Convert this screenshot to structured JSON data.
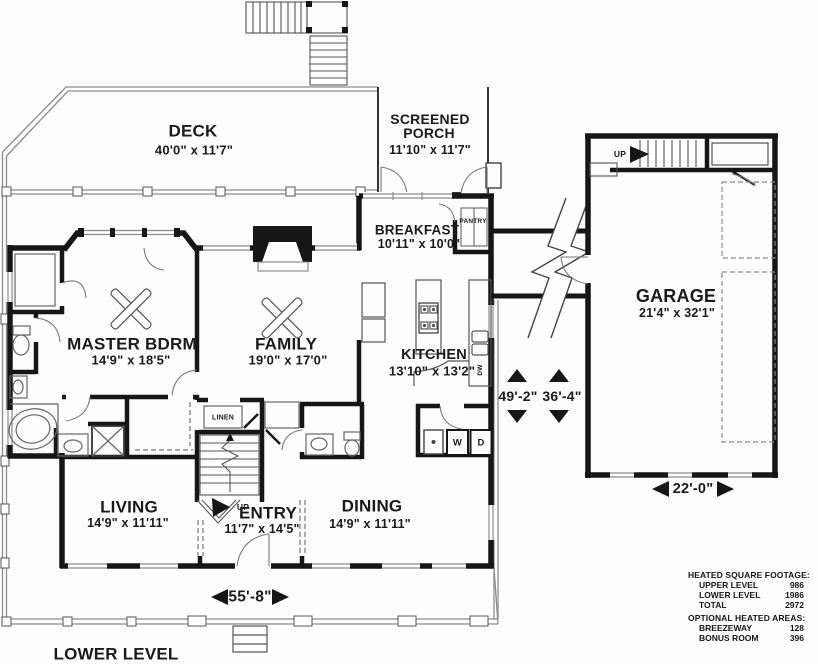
{
  "plan": {
    "level_title": "LOWER LEVEL",
    "rooms": {
      "deck": {
        "name": "DECK",
        "dims": "40'0\" x 11'7\""
      },
      "screened_porch": {
        "line1": "SCREENED",
        "line2": "PORCH",
        "dims": "11'10\" x 11'7\""
      },
      "breakfast": {
        "name": "BREAKFAST",
        "dims": "10'11\" x 10'0\""
      },
      "pantry": {
        "name": "PANTRY"
      },
      "master_bdrm": {
        "name": "MASTER BDRM",
        "dims": "14'9\" x 18'5\""
      },
      "family": {
        "name": "FAMILY",
        "dims": "19'0\" x 17'0\""
      },
      "kitchen": {
        "name": "KITCHEN",
        "dims": "13'10\" x 13'2\""
      },
      "garage": {
        "name": "GARAGE",
        "dims": "21'4\" x 32'1\""
      },
      "living": {
        "name": "LIVING",
        "dims": "14'9\" x 11'11\""
      },
      "entry": {
        "name": "ENTRY",
        "dims": "11'7\" x 14'5\""
      },
      "dining": {
        "name": "DINING",
        "dims": "14'9\" x 11'11\""
      },
      "linen": {
        "name": "LINEN"
      }
    },
    "markers": {
      "up_stairs_entry": "UP",
      "up_stairs_garage": "UP",
      "washer": "W",
      "dryer": "D",
      "dishwasher": "DW"
    },
    "dimensions": {
      "overall_width": "49'-2\"",
      "overall_depth": "36'-4\"",
      "garage_width": "22'-0\"",
      "house_width": "55'-8\""
    },
    "square_footage": {
      "heated_title": "HEATED SQUARE FOOTAGE:",
      "heated_rows": [
        {
          "label": "UPPER LEVEL",
          "value": "986"
        },
        {
          "label": "LOWER LEVEL",
          "value": "1986"
        },
        {
          "label": "TOTAL",
          "value": "2972"
        }
      ],
      "optional_title": "OPTIONAL HEATED AREAS:",
      "optional_rows": [
        {
          "label": "BREEZEWAY",
          "value": "128"
        },
        {
          "label": "BONUS ROOM",
          "value": "396"
        }
      ]
    },
    "colors": {
      "line": "#161616",
      "thin": "#555555",
      "light": "#8c8c8c"
    }
  }
}
